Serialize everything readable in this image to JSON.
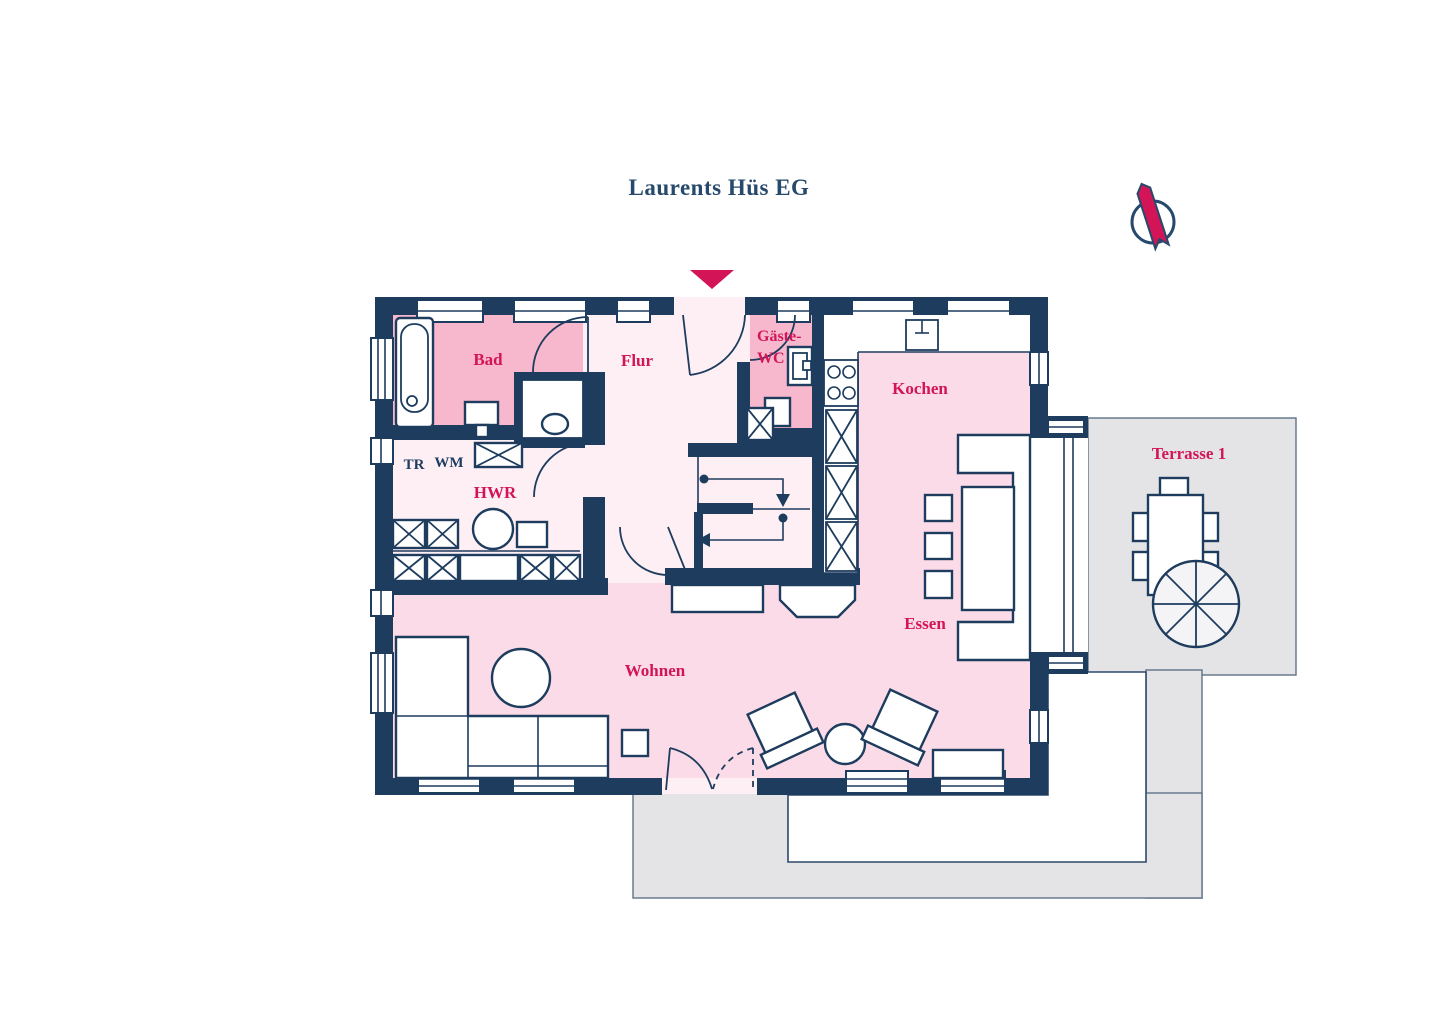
{
  "title": "Laurents Hüs EG",
  "colors": {
    "wall_navy": "#1e3c5e",
    "accent_crimson": "#d31558",
    "room_pink_dark": "#f7b7cd",
    "room_pink_mid": "#fadbe7",
    "room_pink_light": "#fdeff4",
    "terrace_gray": "#e4e4e6",
    "furniture_white": "#ffffff",
    "title_navy": "#27496b"
  },
  "rooms": {
    "bad": {
      "label": "Bad"
    },
    "flur": {
      "label": "Flur"
    },
    "gaeste_wc": {
      "label_line1": "Gäste-",
      "label_line2": "WC"
    },
    "kochen": {
      "label": "Kochen"
    },
    "hwr": {
      "label": "HWR"
    },
    "essen": {
      "label": "Essen"
    },
    "wohnen": {
      "label": "Wohnen"
    },
    "terrasse": {
      "label": "Terrasse 1"
    }
  },
  "appliances": {
    "tr": "TR",
    "wm": "WM"
  },
  "icons": {
    "entrance_marker": "down-triangle",
    "compass": "north-ribbon-circle"
  }
}
